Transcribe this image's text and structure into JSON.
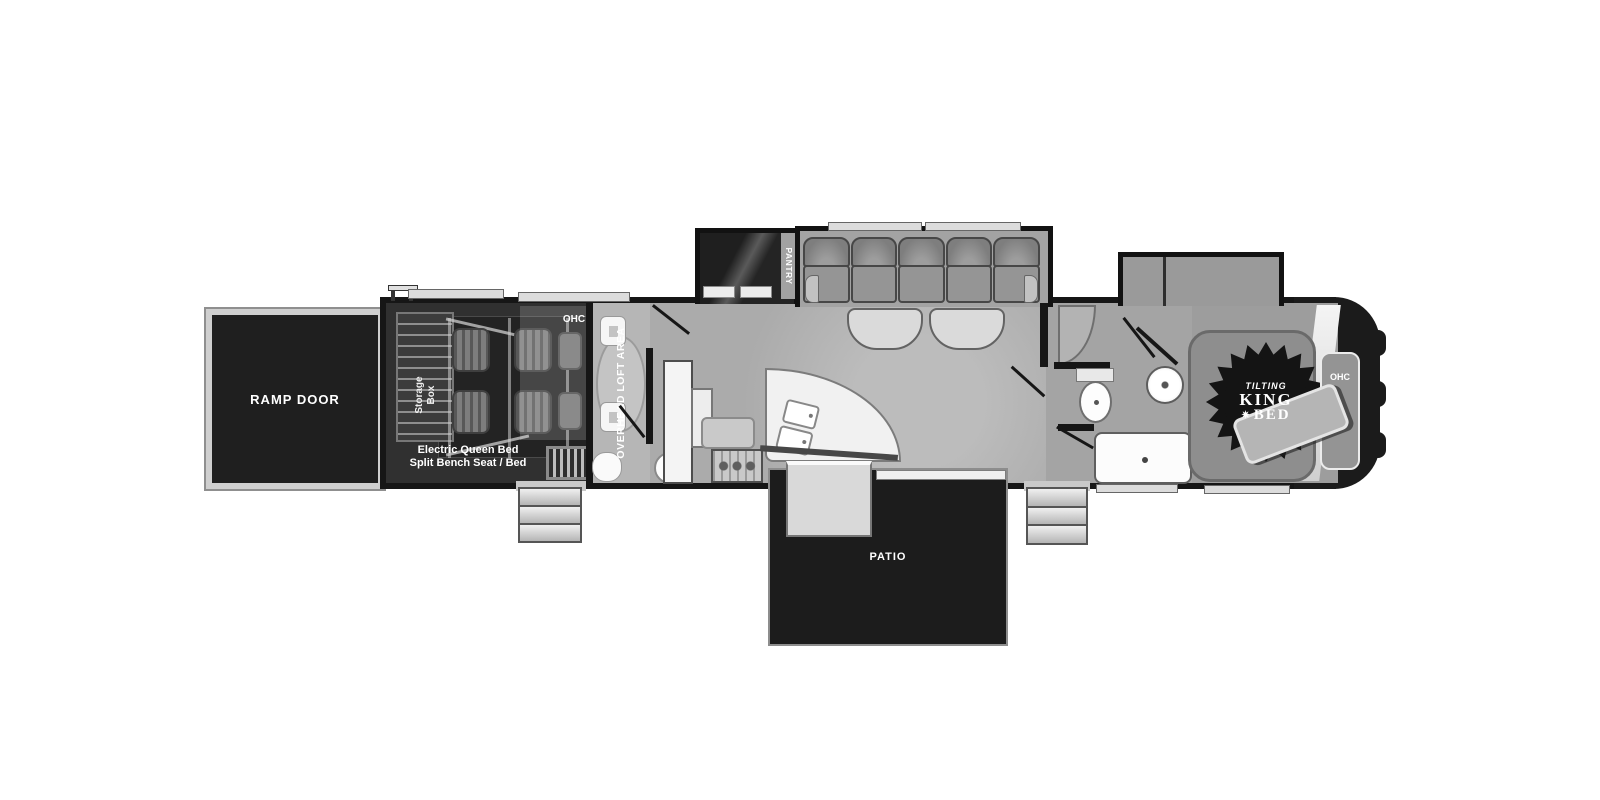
{
  "labels": {
    "ramp_door": "RAMP DOOR",
    "storage_line1": "Storage",
    "storage_line2": "Box",
    "garage_ohc": "OHC",
    "garage_note1": "Electric Queen Bed",
    "garage_note2": "Split Bench Seat / Bed",
    "loft": "OVERHEAD LOFT AREA",
    "pantry": "PANTRY",
    "patio": "PATIO",
    "badge_tilting": "TILTING",
    "badge_king": "KING",
    "badge_bed": "BED",
    "bedroom_ohc": "OHC"
  },
  "icons": {
    "bed_badge_burst": "✷"
  },
  "colors": {
    "wall": "#161616",
    "floor": "#a9a9a9",
    "garage_floor": "#303030",
    "black_box": "#1c1c1c",
    "fixture_white": "#ffffff",
    "trim_light": "#dcdcdc",
    "badge_black": "#141414"
  }
}
